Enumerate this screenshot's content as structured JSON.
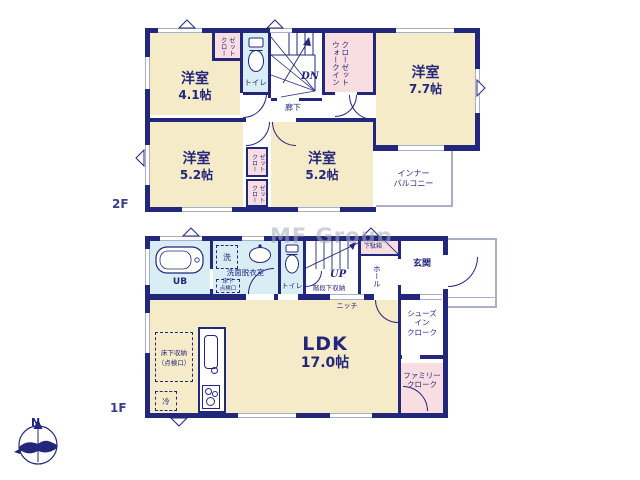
{
  "watermark": "MF Group",
  "compass": {
    "north": "N"
  },
  "colors": {
    "wall": "#23277b",
    "cream": "#f6ebc8",
    "pink": "#f9dee1",
    "bath": "#d9edf4",
    "line": "#a9aec9",
    "watermark": "#a9adbb",
    "text": "#23277b"
  },
  "f2": {
    "label": "2F",
    "room41": {
      "name": "洋室",
      "size": "4.1帖"
    },
    "room77": {
      "name": "洋室",
      "size": "7.7帖"
    },
    "room52l": {
      "name": "洋室",
      "size": "5.2帖"
    },
    "room52r": {
      "name": "洋室",
      "size": "5.2帖"
    },
    "closet_top": "クロー\nゼット",
    "closet1": "クロー\nゼット",
    "closet2": "クロー\nゼット",
    "wic": "ウォークイン\nクローゼット",
    "toilet": "トイレ",
    "dn": "DN",
    "corridor": "廊下",
    "balcony": "インナー\nバルコニー"
  },
  "f1": {
    "label": "1F",
    "ub": "UB",
    "washer": "洗",
    "washroom": "洗面脱衣室",
    "hatch": "床下\n点検口",
    "toilet": "トイレ",
    "up": "UP",
    "stair_storage": "階段下収納",
    "shoe_box": "下駄箱",
    "hall": "ホール",
    "entrance": "玄関",
    "niche": "ニッチ",
    "shoes_cloak": "シューズ\nイン\nクローク",
    "family_cloak": "ファミリー\nクローク",
    "ldk": {
      "name": "LDK",
      "size": "17.0帖"
    },
    "floor_storage": "床下収納\n（点検口）",
    "fridge": "冷"
  }
}
